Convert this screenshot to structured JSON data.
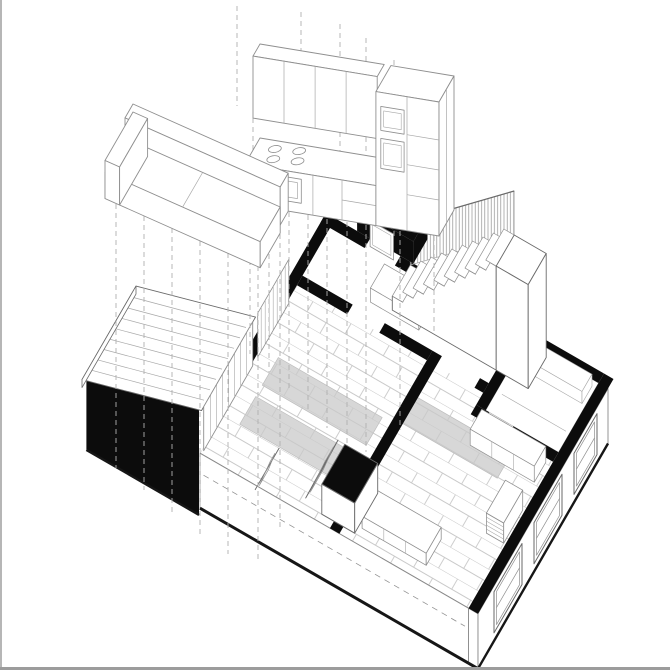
{
  "meta": {
    "label": "axonometric-floor-plan-drawing"
  },
  "canvas": {
    "background": "#ffffff",
    "frame_border": "#b6b6b6"
  },
  "palette": {
    "wall": "#0c0c0c",
    "ink": "#161616",
    "line": "#6a6a6a",
    "line_mid": "#8f8f8f",
    "line_light": "#a8a8a8",
    "tile": "#c9c9c9",
    "rug": "#d7d7d7",
    "rug_edge": "#bdbdbd",
    "hatch": "#909090",
    "dash": "#b0b0b0",
    "white": "#ffffff",
    "slab_edge": "#8a8a8a"
  },
  "elements": [
    {
      "name": "kitchen-unit",
      "kind": "floating-furniture"
    },
    {
      "name": "kitchen-hob",
      "kind": "appliance"
    },
    {
      "name": "kitchen-oven",
      "kind": "appliance"
    },
    {
      "name": "kitchen-tall-cabinet",
      "kind": "floating-furniture"
    },
    {
      "name": "sofa-unit",
      "kind": "floating-furniture"
    },
    {
      "name": "projection-dashed-lines",
      "kind": "construction-lines"
    },
    {
      "name": "floor-plan-walls",
      "kind": "wall-poche"
    },
    {
      "name": "entrance-porch",
      "kind": "structure"
    },
    {
      "name": "staircase",
      "kind": "structure"
    },
    {
      "name": "stair-balustrade-hatch",
      "kind": "structure"
    },
    {
      "name": "store-room",
      "kind": "room"
    },
    {
      "name": "hallway",
      "kind": "room"
    },
    {
      "name": "front-room",
      "kind": "room"
    },
    {
      "name": "back-room",
      "kind": "room"
    },
    {
      "name": "bay-extension-roof",
      "kind": "structure"
    },
    {
      "name": "bay-extension-wall",
      "kind": "wall-poche"
    },
    {
      "name": "glazed-screen",
      "kind": "structure"
    },
    {
      "name": "chimney-breast",
      "kind": "structure"
    },
    {
      "name": "leaning-mirror",
      "kind": "furniture"
    },
    {
      "name": "media-bench",
      "kind": "furniture"
    },
    {
      "name": "radiator",
      "kind": "furniture"
    },
    {
      "name": "floor-tiles",
      "kind": "finish"
    },
    {
      "name": "gray-rug",
      "kind": "finish"
    },
    {
      "name": "rear-windows",
      "kind": "opening"
    },
    {
      "name": "floor-slab-edge",
      "kind": "structure"
    }
  ]
}
